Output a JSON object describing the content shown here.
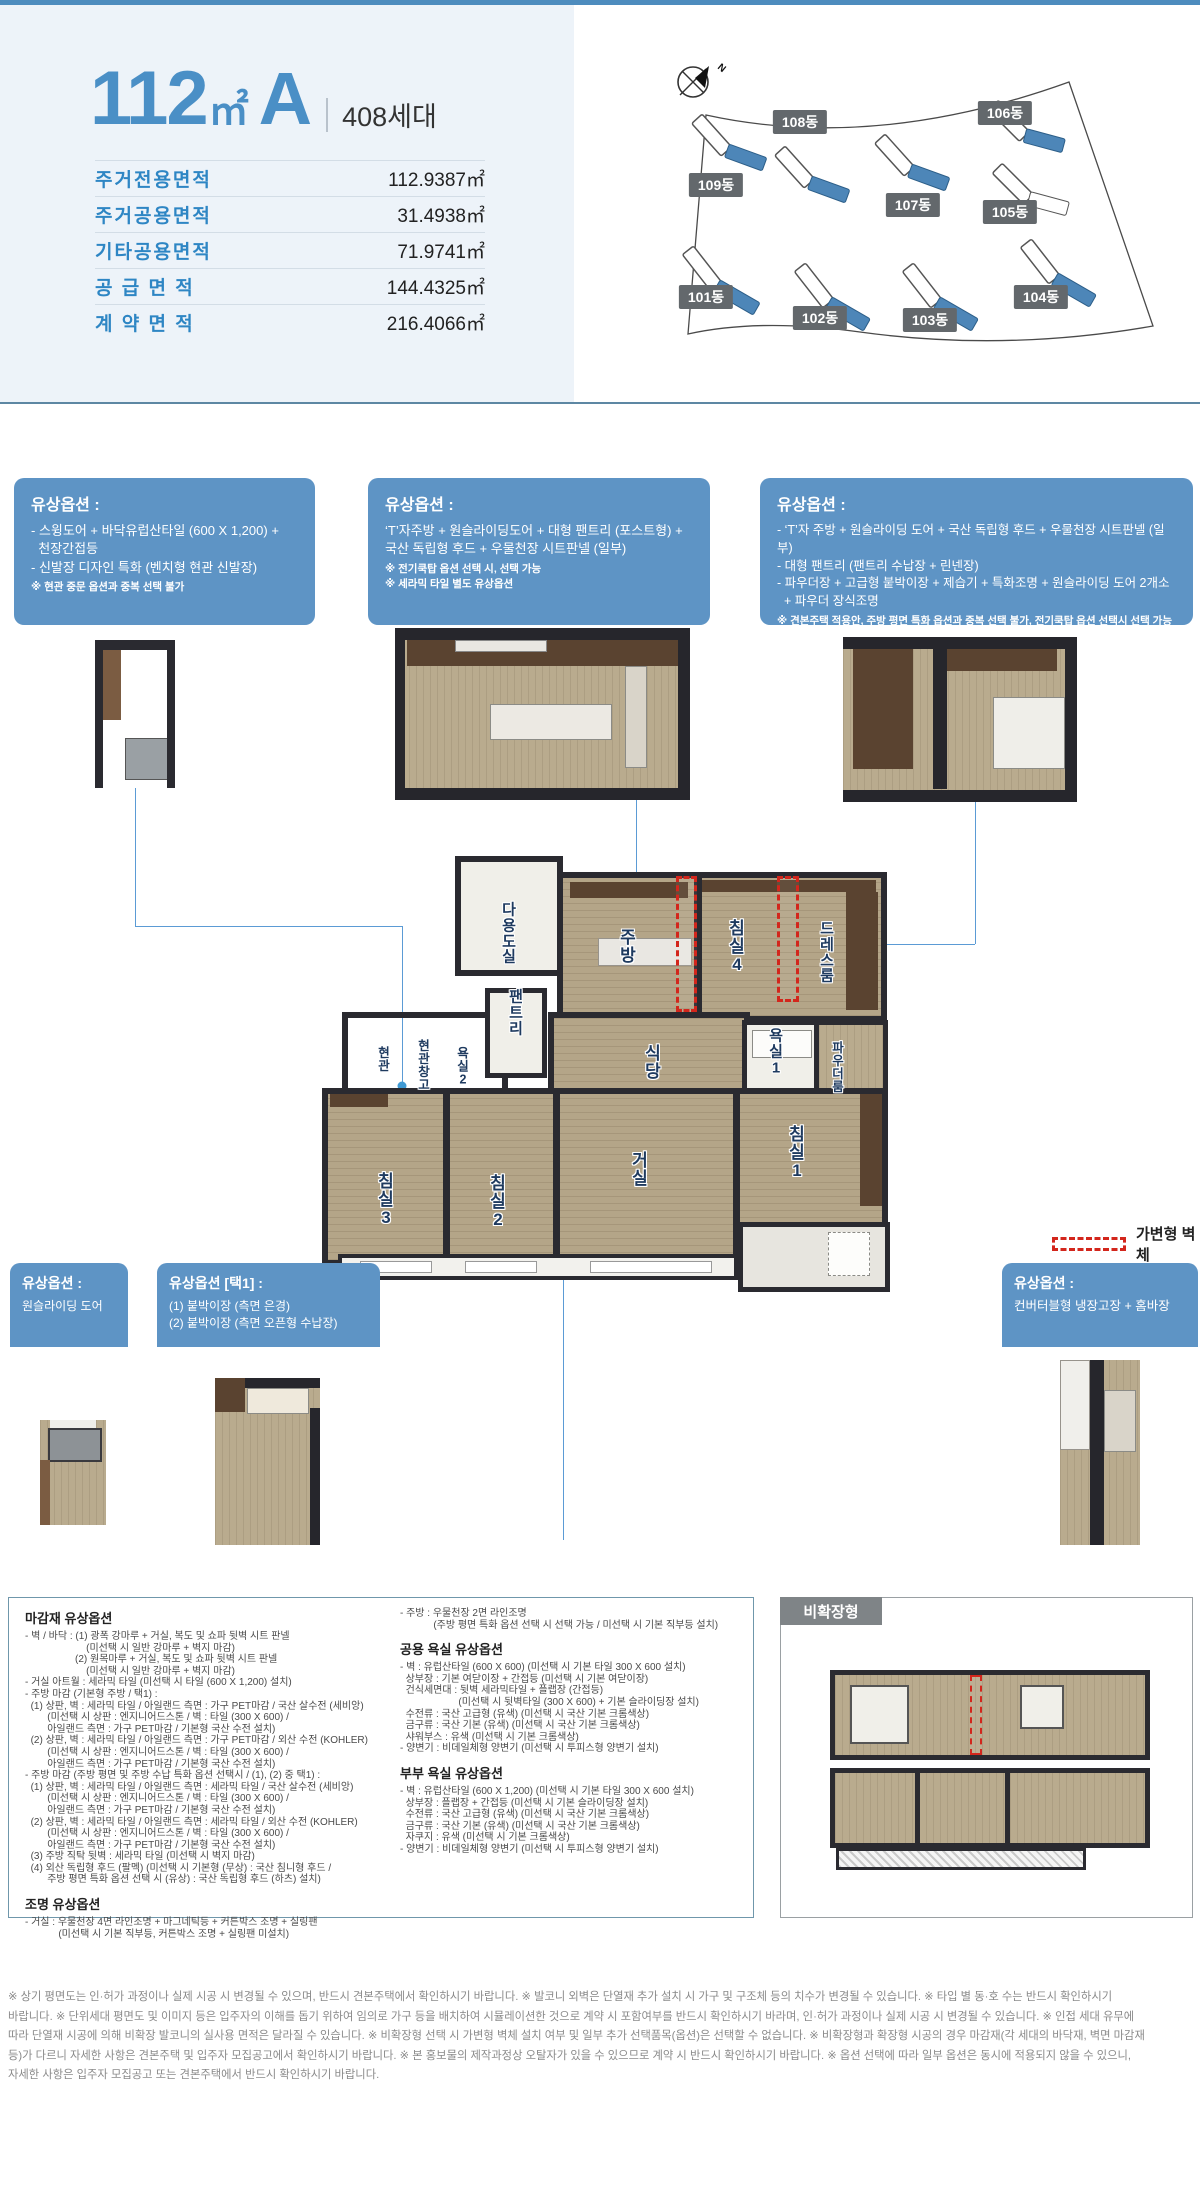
{
  "header": {
    "size": "112",
    "unit": "㎡",
    "type": "A",
    "households": "408세대",
    "table": [
      {
        "label": "주거전용면적",
        "value": "112.9387㎡"
      },
      {
        "label": "주거공용면적",
        "value": "31.4938㎡"
      },
      {
        "label": "기타공용면적",
        "value": "71.9741㎡"
      },
      {
        "label": "공 급 면 적",
        "value": "144.4325㎡"
      },
      {
        "label": "계 약 면 적",
        "value": "216.4066㎡"
      }
    ]
  },
  "site_plan": {
    "compass": "N",
    "buildings": [
      "101동",
      "102동",
      "103동",
      "104동",
      "105동",
      "106동",
      "107동",
      "108동",
      "109동"
    ]
  },
  "option_boxes": {
    "box1": {
      "title": "유상옵션 :",
      "items": [
        "- 스윙도어 + 바닥유럽산타일 (600 X 1,200) +",
        "  천장간접등",
        "- 신발장 디자인 특화 (벤치형 현관 신발장)"
      ],
      "notes": [
        "※ 현관 중문 옵션과 중복 선택 불가"
      ]
    },
    "box2": {
      "title": "유상옵션 :",
      "items": [
        "‘T’자주방 + 원슬라이딩도어 + 대형 팬트리 (포스트형) +",
        "국산 독립형 후드 + 우물천장 시트판넬 (일부)"
      ],
      "notes": [
        "※ 전기쿡탑 옵션 선택 시, 선택 가능",
        "※ 세라믹 타일 별도 유상옵션"
      ]
    },
    "box3": {
      "title": "유상옵션 :",
      "items": [
        "- ‘T’자 주방 + 원슬라이딩 도어 + 국산 독립형 후드 + 우물천장 시트판넬 (일부)",
        "- 대형 팬트리 (팬트리 수납장 + 린넨장)",
        "- 파우더장 + 고급형 붙박이장 + 제습기 + 특화조명 + 원슬라이딩 도어 2개소",
        "  + 파우더 장식조명"
      ],
      "notes": [
        "※ 견본주택 적용안, 주방 평면 특화 옵션과 중복 선택 불가, 전기쿡탑 옵션 선택시 선택 가능",
        "※ 세라믹 타일 별도 유상옵션"
      ]
    }
  },
  "floor_plan": {
    "rooms": [
      "다용도실",
      "주방",
      "침실4",
      "드레스룸",
      "팬트리",
      "현관",
      "현관\n창고",
      "욕실2",
      "식당",
      "욕실1",
      "파우더룸",
      "거실",
      "침실1",
      "침실2",
      "침실3"
    ],
    "legend": "가변형 벽체"
  },
  "bottom_boxes": {
    "a": {
      "title": "유상옵션 :",
      "items": [
        "원슬라이딩 도어"
      ]
    },
    "b": {
      "title": "유상옵션 [택1] :",
      "items": [
        "(1) 붙박이장 (측면 은경)",
        "(2) 붙박이장 (측면 오픈형 수납장)"
      ]
    },
    "c": {
      "title": "유상옵션 :",
      "items": [
        "컨버터블형 냉장고장 + 홈바장"
      ]
    }
  },
  "specs": {
    "left": {
      "h1": "마감재 유상옵션",
      "body1": [
        "- 벽 / 바닥 : (1) 광폭 강마루 + 거실, 복도 및 쇼파 뒷벽 시트 판넬",
        "                      (미선택 시 일반 강마루 + 벽지 마감)",
        "                  (2) 원목마루 + 거실, 복도 및 쇼파 뒷벽 시트 판넬",
        "                      (미선택 시 일반 강마루 + 벽지 마감)",
        "- 거실 아트월 : 세라믹 타일 (미선택 시 타일 (600 X 1,200) 설치)",
        "- 주방 마감 (기본형 주방 / 택1) :",
        "  (1) 상판, 벽 : 세라믹 타일 / 아일랜드 측면 : 가구 PET마감 / 국산 살수전 (세비앙)",
        "        (미선택 시 상판 : 엔지니어드스톤 / 벽 : 타일 (300 X 600) /",
        "        아일랜드 측면 : 가구 PET마감 / 기본형 국산 수전 설치)",
        "  (2) 상판, 벽 : 세라믹 타일 / 아일랜드 측면 : 가구 PET마감 / 외산 수전 (KOHLER)",
        "        (미선택 시 상판 : 엔지니어드스톤 / 벽 : 타일 (300 X 600) /",
        "        아일랜드 측면 : 가구 PET마감 / 기본형 국산 수전 설치)",
        "- 주방 마감 (주방 평면 및 주방 수납 특화 옵션 선택시 / (1), (2) 중 택1) :",
        "  (1) 상판, 벽 : 세라믹 타일 / 아일랜드 측면 : 세라믹 타일 / 국산 살수전 (세비앙)",
        "        (미선택 시 상판 : 엔지니어드스톤 / 벽 : 타일 (300 X 600) /",
        "        아일랜드 측면 : 가구 PET마감 / 기본형 국산 수전 설치)",
        "  (2) 상판, 벽 : 세라믹 타일 / 아일랜드 측면 : 세라믹 타일 / 외산 수전 (KOHLER)",
        "        (미선택 시 상판 : 엔지니어드스톤 / 벽 : 타일 (300 X 600) /",
        "        아일랜드 측면 : 가구 PET마감 / 기본형 국산 수전 설치)",
        "  (3) 주방 직탁 뒷벽 : 세라믹 타일 (미선택 시 벽지 마감)",
        "  (4) 외산 독립형 후드 (팔멕) (미선택 시 기본형 (무상) : 국산 침니형 후드 /",
        "        주방 평면 특화 옵션 선택 시 (유상) : 국산 독립형 후드 (하츠) 설치)"
      ],
      "h2": "조명 유상옵션",
      "body2": [
        "- 거실 : 우물천장 4면 라인조명 + 마그네틱등 + 커튼박스 조명 + 실링팬",
        "            (미선택 시 기본 직부등, 커튼박스 조명 + 실링팬 미설치)"
      ]
    },
    "mid": {
      "body0": [
        "- 주방 : 우물천장 2면 라인조명",
        "            (주방 평면 특화 옵션 선택 시 선택 가능 / 미선택 시 기본 직부등 설치)"
      ],
      "h1": "공용 욕실 유상옵션",
      "body1": [
        "- 벽 : 유럽산타일 (600 X 600) (미선택 시 기본 타일 300 X 600 설치)",
        "  상부장 : 기본 여닫이장 + 간접등 (미선택 시 기본 여닫이장)",
        "  건식세면대 : 뒷벽 세라믹타일 + 플랩장 (간접등)",
        "                     (미선택 시 뒷벽타일 (300 X 600) + 기본 슬라이딩장 설치)",
        "  수전류 : 국산 고급형 (유색) (미선택 시 국산 기본 크롬색상)",
        "  금구류 : 국산 기본 (유색) (미선택 시 국산 기본 크롬색상)",
        "  샤워부스 : 유색 (미선택 시 기본 크롬색상)",
        "- 양변기 : 비데일체형 양변기 (미선택 시 투피스형 양변기 설치)"
      ],
      "h2": "부부 욕실 유상옵션",
      "body2": [
        "- 벽 : 유럽산타일 (600 X 1,200) (미선택 시 기본 타일 300 X 600 설치)",
        "  상부장 : 플랩장 + 간접등 (미선택 시 기본 슬라이딩장 설치)",
        "  수전류 : 국산 고급형 (유색) (미선택 시 국산 기본 크롬색상)",
        "  금구류 : 국산 기본 (유색) (미선택 시 국산 기본 크롬색상)",
        "  자쿠지 : 유색 (미선택 시 기본 크롬색상)",
        "- 양변기 : 비데일체형 양변기 (미선택 시 투피스형 양변기 설치)"
      ]
    }
  },
  "unexpanded": {
    "label": "비확장형"
  },
  "footer": {
    "lines": [
      "※ 상기 평면도는 인·허가 과정이나 실제 시공 시 변경될 수 있으며, 반드시 견본주택에서 확인하시기 바랍니다. ※ 발코니 외벽은 단열재 추가 설치 시 가구 및 구조체 등의 치수가 변경될 수 있습니다. ※ 타입 별 동·호 수는 반드시 확인하시기",
      "바랍니다. ※ 단위세대 평면도 및 이미지 등은 입주자의 이해를 돕기 위하여 임의로 가구 등을 배치하여 시뮬레이션한 것으로 계약 시 포함여부를 반드시 확인하시기 바라며, 인·허가 과정이나 실제 시공 시 변경될 수 있습니다. ※ 인접 세대 유무에",
      "따라 단열재 시공에 의해 비확장 발코니의 실사용 면적은 달라질 수 있습니다. ※ 비확장형 선택 시 가변형 벽체 설치 여부 및 일부 추가 선택품목(옵션)은 선택할 수 없습니다. ※ 비확장형과 확장형 시공의 경우 마감재(각 세대의 바닥재, 벽면 마감재",
      "등)가 다르니 자세한 사항은 견본주택 및 입주자 모집공고에서 확인하시기 바랍니다. ※ 본 홍보물의 제작과정상 오탈자가 있을 수 있으므로 계약 시 반드시 확인하시기 바랍니다. ※ 옵션 선택에 따라 일부 옵션은 동시에 적용되지 않을 수 있으니,",
      "자세한 사항은 입주자 모집공고 또는 견본주택에서 반드시 확인하시기 바랍니다."
    ]
  }
}
